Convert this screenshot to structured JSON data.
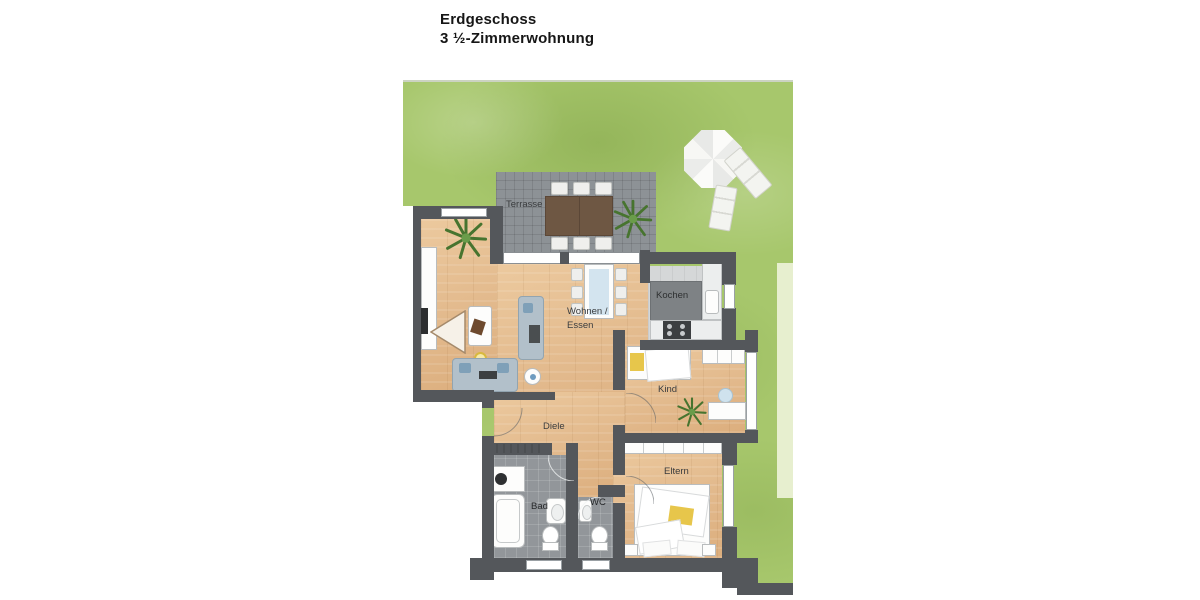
{
  "title": {
    "line1": "Erdgeschoss",
    "line2": "3 ½-Zimmerwohnung"
  },
  "rooms": {
    "terrasse": {
      "label": "Terrasse"
    },
    "wohnen_essen": {
      "label_line1": "Wohnen /",
      "label_line2": "Essen"
    },
    "kochen": {
      "label": "Kochen"
    },
    "kind": {
      "label": "Kind"
    },
    "diele": {
      "label": "Diele"
    },
    "bad": {
      "label": "Bad"
    },
    "wc": {
      "label": "WC"
    },
    "eltern": {
      "label": "Eltern"
    }
  },
  "palette": {
    "wall_gray": "#54575b",
    "wood_floor": "#e2b98c",
    "lawn_green": "#a7c76c",
    "terrace_paving_gray": "#8d9296",
    "bathroom_tile_gray": "#92969a",
    "kitchen_floor_gray": "#d5d7d8",
    "accent_yellow": "#e7c64b",
    "sofa_blue_gray": "#b2c0ca",
    "garden_path_pale_green": "#e7efcf",
    "terrace_table_brown": "#6e5743"
  }
}
